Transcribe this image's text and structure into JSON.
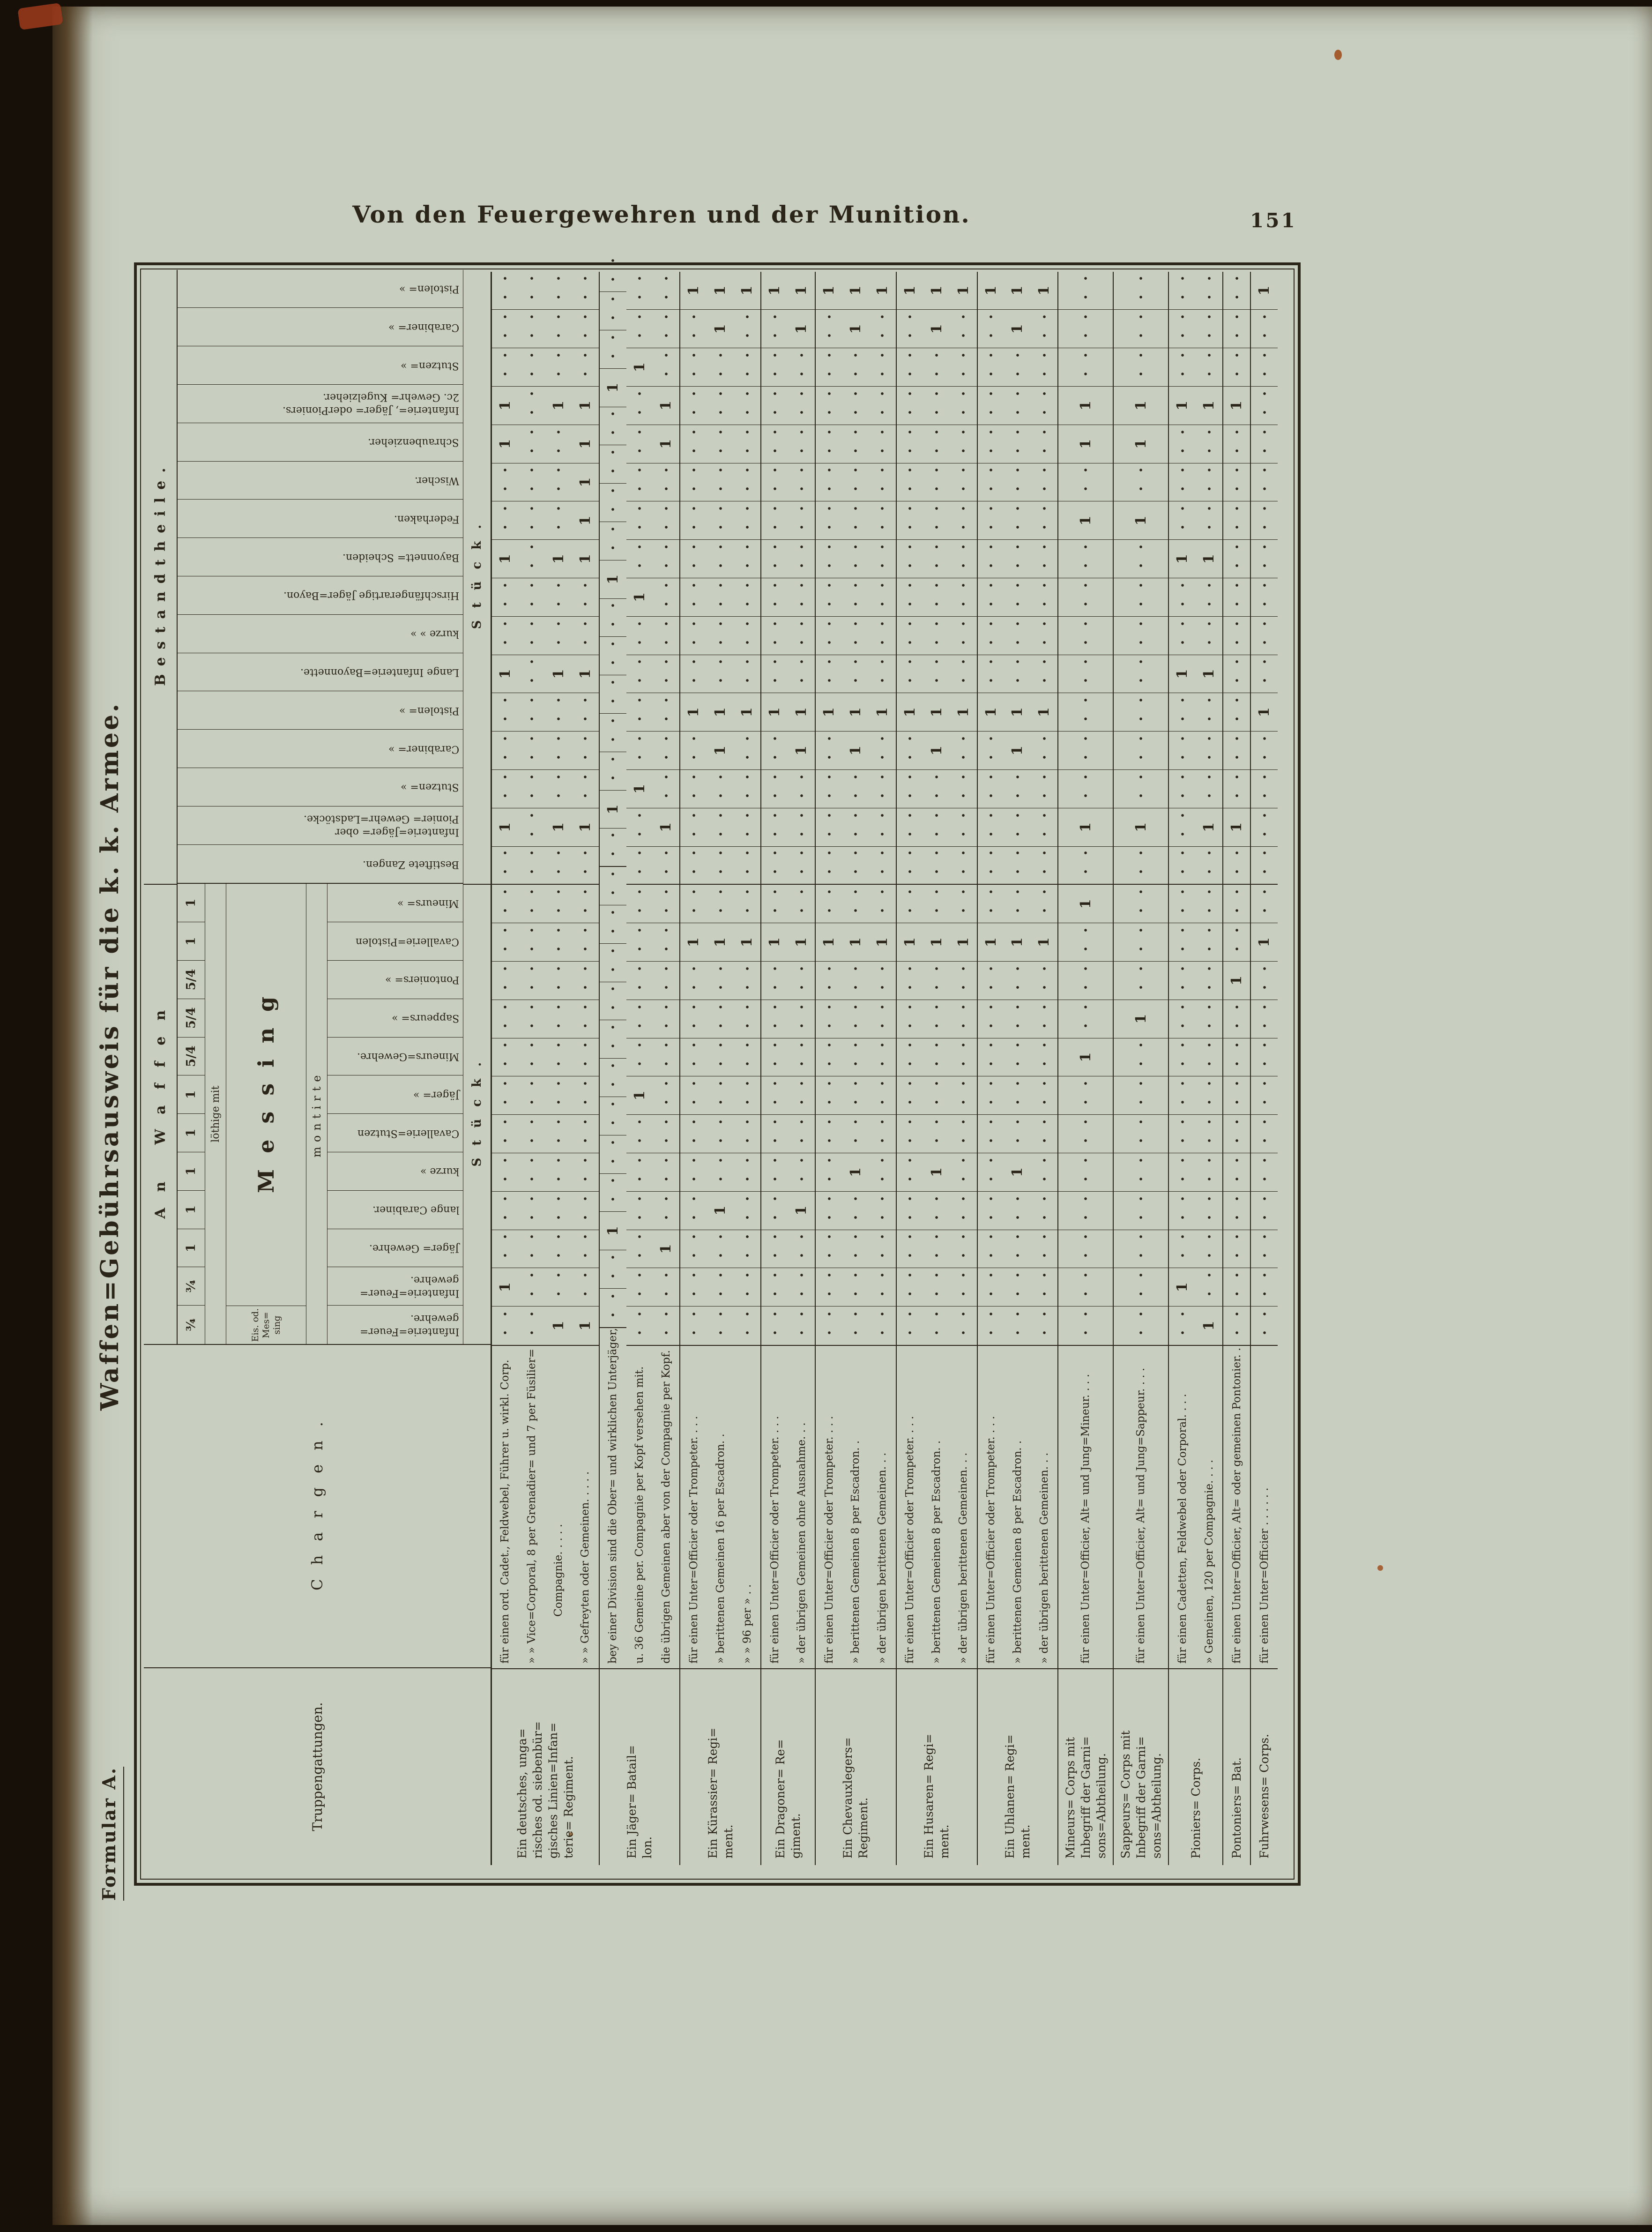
{
  "page": {
    "header_title": "Von den Feuergewehren und der Munition.",
    "page_number": "151",
    "side_title": "Waffen=Gebührsausweis für die k. k. Armee.",
    "formular_label": "Formular A."
  },
  "colors": {
    "paper": "#c9cfc0",
    "ink": "#2b2418",
    "book_edge": "#2c1d0c",
    "rust_speck": "#a0501e",
    "red_mark": "#9e3a1c"
  },
  "table": {
    "headers": {
      "truppengattungen": "Truppengattungen.",
      "chargen": "Chargen.",
      "group_waffen": "An Waffen",
      "group_bestandtheile": "Bestandtheile.",
      "loethige_mit": "löthige mit",
      "messing": "Messing",
      "montirte": "montirte",
      "eis_od_messing_lines": [
        "Eis. od.",
        "Mes=",
        "sing"
      ],
      "stueck": "Stück."
    },
    "waffen_columns": [
      {
        "frac": "¾",
        "lines": [
          "Infanterie=Feuer=",
          "gewehre."
        ]
      },
      {
        "frac": "¾",
        "lines": [
          "Infanterie=Feuer=",
          "gewehre."
        ]
      },
      {
        "frac": "1",
        "lines": [
          "Jäger= Gewehre."
        ]
      },
      {
        "frac": "1",
        "lines": [
          "lange Carabiner."
        ]
      },
      {
        "frac": "1",
        "lines": [
          "kurze  »"
        ]
      },
      {
        "frac": "1",
        "lines": [
          "Cavallerie=Stutzen"
        ]
      },
      {
        "frac": "1",
        "lines": [
          "Jäger=  »"
        ]
      },
      {
        "frac": "5/4",
        "lines": [
          "Mineurs=Gewehre."
        ]
      },
      {
        "frac": "5/4",
        "lines": [
          "Sappeurs=  »"
        ]
      },
      {
        "frac": "5/4",
        "lines": [
          "Pontoniers=  »"
        ]
      },
      {
        "frac": "1",
        "lines": [
          "Cavallerie=Pistolen"
        ]
      },
      {
        "frac": "1",
        "lines": [
          "Mineurs=  »"
        ]
      }
    ],
    "bestandtheile_columns": [
      {
        "lines": [
          "Bestiftete Zangen."
        ]
      },
      {
        "lines": [
          "Infanterie=Jäger= ober",
          "Pionier= Gewehr=Ladstöcke."
        ]
      },
      {
        "lines": [
          "Stutzen=  »"
        ]
      },
      {
        "lines": [
          "Carabiner=  »"
        ]
      },
      {
        "lines": [
          "Pistolen=  »"
        ]
      },
      {
        "lines": [
          "Lange Infanterie=Bayonnette."
        ]
      },
      {
        "lines": [
          "kurze  »  »"
        ]
      },
      {
        "lines": [
          "Hirschfängerartige Jäger=Bayon."
        ]
      },
      {
        "lines": [
          "Bayonnett= Scheiden."
        ]
      },
      {
        "lines": [
          "Federhaken."
        ]
      },
      {
        "lines": [
          "Wischer."
        ]
      },
      {
        "lines": [
          "Schraubenzieher."
        ]
      },
      {
        "lines": [
          "Infanterie=, Jäger= oderPioniers.",
          "2c. Gewehr= Kugelzieher."
        ]
      },
      {
        "lines": [
          "Stutzen=  »"
        ]
      },
      {
        "lines": [
          "Carabiner=  »"
        ]
      },
      {
        "lines": [
          "Pistolen=  »"
        ]
      }
    ],
    "groups": [
      {
        "label_lines": [
          "Ein deutsches, unga=",
          "risches od. siebenbür=",
          "gisches Linien=Infan=",
          "terie= Regiment."
        ],
        "lines": [
          {
            "text": "für einen ord. Cadet., Feldwebel, Führer u. wirkl. Corp.",
            "values": {
              "2": "1",
              "14": "1",
              "18": "1",
              "21": "1",
              "24": "1",
              "25": "1"
            }
          },
          {
            "text": "»  »  Vice=Corporal, 8 per Grenadier= und 7 per Füsilier=",
            "values": {}
          },
          {
            "text": "Compagnie. .  .  .  .",
            "indent": true,
            "values": {
              "1": "1",
              "14": "1",
              "18": "1",
              "21": "1",
              "25": "1"
            }
          },
          {
            "text": "»  »  Gefreyten oder Gemeinen. .  .  .  .",
            "values": {
              "1": "1",
              "14": "1",
              "18": "1",
              "21": "1",
              "22": "1",
              "23": "1",
              "24": "1",
              "25": "1"
            }
          }
        ]
      },
      {
        "label_lines": [
          "Ein Jäger= Batail=",
          "lon."
        ],
        "lines": [
          {
            "text": "bey einer Division sind die Ober= und wirklichen Unterjäger,",
            "values": {
              "3": "1",
              "14": "1",
              "20": "1",
              "25": "1"
            }
          },
          {
            "text": "u. 36 Gemeine per. Compagnie per Kopf versehen mit.",
            "values": {
              "7": "1",
              "15": "1",
              "20": "1",
              "26": "1"
            }
          },
          {
            "text": "die übrigen Gemeinen aber von der Compagnie per Kopf.",
            "values": {
              "3": "1",
              "14": "1",
              "24": "1",
              "25": "1"
            }
          }
        ]
      },
      {
        "label_lines": [
          "Ein Kürassier= Regi=",
          "ment."
        ],
        "lines": [
          {
            "text": "für einen Unter=Officier oder Trompeter. .  .  .",
            "values": {
              "11": "1",
              "17": "1",
              "28": "1"
            }
          },
          {
            "text": "»  berittenen Gemeinen 16 per Escadron. .",
            "values": {
              "4": "1",
              "11": "1",
              "16": "1",
              "17": "1",
              "27": "1",
              "28": "1"
            }
          },
          {
            "text": "»   »    96 per  »  .  .",
            "values": {
              "11": "1",
              "17": "1",
              "28": "1"
            }
          }
        ]
      },
      {
        "label_lines": [
          "Ein Dragoner= Re=",
          "giment."
        ],
        "lines": [
          {
            "text": "für einen Unter=Officier oder Trompeter. .  .  .",
            "values": {
              "11": "1",
              "17": "1",
              "28": "1"
            }
          },
          {
            "text": "»  der übrigen Gemeinen ohne Ausnahme. .  .",
            "values": {
              "4": "1",
              "11": "1",
              "16": "1",
              "17": "1",
              "27": "1",
              "28": "1"
            }
          }
        ]
      },
      {
        "label_lines": [
          "Ein Chevauxlegers=",
          "Regiment."
        ],
        "lines": [
          {
            "text": "für einen Unter=Officier oder Trompeter. .  .  .",
            "values": {
              "11": "1",
              "17": "1",
              "28": "1"
            }
          },
          {
            "text": "»  berittenen Gemeinen 8 per Escadron. .",
            "values": {
              "5": "1",
              "11": "1",
              "16": "1",
              "17": "1",
              "27": "1",
              "28": "1"
            }
          },
          {
            "text": "»  der übrigen berittenen Gemeinen. .  .",
            "values": {
              "11": "1",
              "17": "1",
              "28": "1"
            }
          }
        ]
      },
      {
        "label_lines": [
          "Ein Husaren= Regi=",
          "ment."
        ],
        "lines": [
          {
            "text": "für einen Unter=Officier oder Trompeter. .  .  .",
            "values": {
              "11": "1",
              "17": "1",
              "28": "1"
            }
          },
          {
            "text": "»  berittenen Gemeinen 8 per Escadron. .",
            "values": {
              "5": "1",
              "11": "1",
              "16": "1",
              "17": "1",
              "27": "1",
              "28": "1"
            }
          },
          {
            "text": "»  der übrigen berittenen Gemeinen. .  .",
            "values": {
              "11": "1",
              "17": "1",
              "28": "1"
            }
          }
        ]
      },
      {
        "label_lines": [
          "Ein Uhlanen= Regi=",
          "ment."
        ],
        "lines": [
          {
            "text": "für einen Unter=Officier oder Trompeter. .  .  .",
            "values": {
              "11": "1",
              "17": "1",
              "28": "1"
            }
          },
          {
            "text": "»  berittenen Gemeinen 8 per Escadron. .",
            "values": {
              "5": "1",
              "11": "1",
              "16": "1",
              "17": "1",
              "27": "1",
              "28": "1"
            }
          },
          {
            "text": "»  der übrigen berittenen Gemeinen. .  .",
            "values": {
              "11": "1",
              "17": "1",
              "28": "1"
            }
          }
        ]
      },
      {
        "label_lines": [
          "Mineurs= Corps  mit",
          "Inbegriff  der  Garni=",
          "sons=Abtheilung."
        ],
        "lines": [
          {
            "text": "für einen Unter=Officier, Alt= und Jung=Mineur. .  .  .",
            "values": {
              "8": "1",
              "12": "1",
              "14": "1",
              "22": "1",
              "24": "1",
              "25": "1"
            }
          }
        ]
      },
      {
        "label_lines": [
          "Sappeurs= Corps mit",
          "Inbegriff  der  Garni=",
          "sons=Abtheilung."
        ],
        "lines": [
          {
            "text": "für einen Unter=Officier, Alt= und Jung=Sappeur. .  .  .",
            "values": {
              "9": "1",
              "14": "1",
              "22": "1",
              "24": "1",
              "25": "1"
            }
          }
        ]
      },
      {
        "label_lines": [
          "Pioniers= Corps."
        ],
        "lines": [
          {
            "text": "für einen Cadetten, Feldwebel oder Corporal. .  .  .",
            "values": {
              "2": "1",
              "18": "1",
              "21": "1",
              "25": "1"
            }
          },
          {
            "text": "»   Gemeinen, 120 per Compagnie. .  .  .",
            "values": {
              "1": "1",
              "14": "1",
              "18": "1",
              "21": "1",
              "25": "1"
            }
          }
        ]
      },
      {
        "label_lines": [
          "Pontoniers= Bat."
        ],
        "lines": [
          {
            "text": "für einen Unter=Officier, Alt= oder gemeinen Pontonier. .",
            "values": {
              "10": "1",
              "14": "1",
              "25": "1"
            }
          }
        ]
      },
      {
        "label_lines": [
          "Fuhrwesens= Corps."
        ],
        "lines": [
          {
            "text": "für einen Unter=Officier .  .  .  .  .  .",
            "values": {
              "11": "1",
              "17": "1",
              "28": "1"
            }
          }
        ]
      }
    ]
  }
}
